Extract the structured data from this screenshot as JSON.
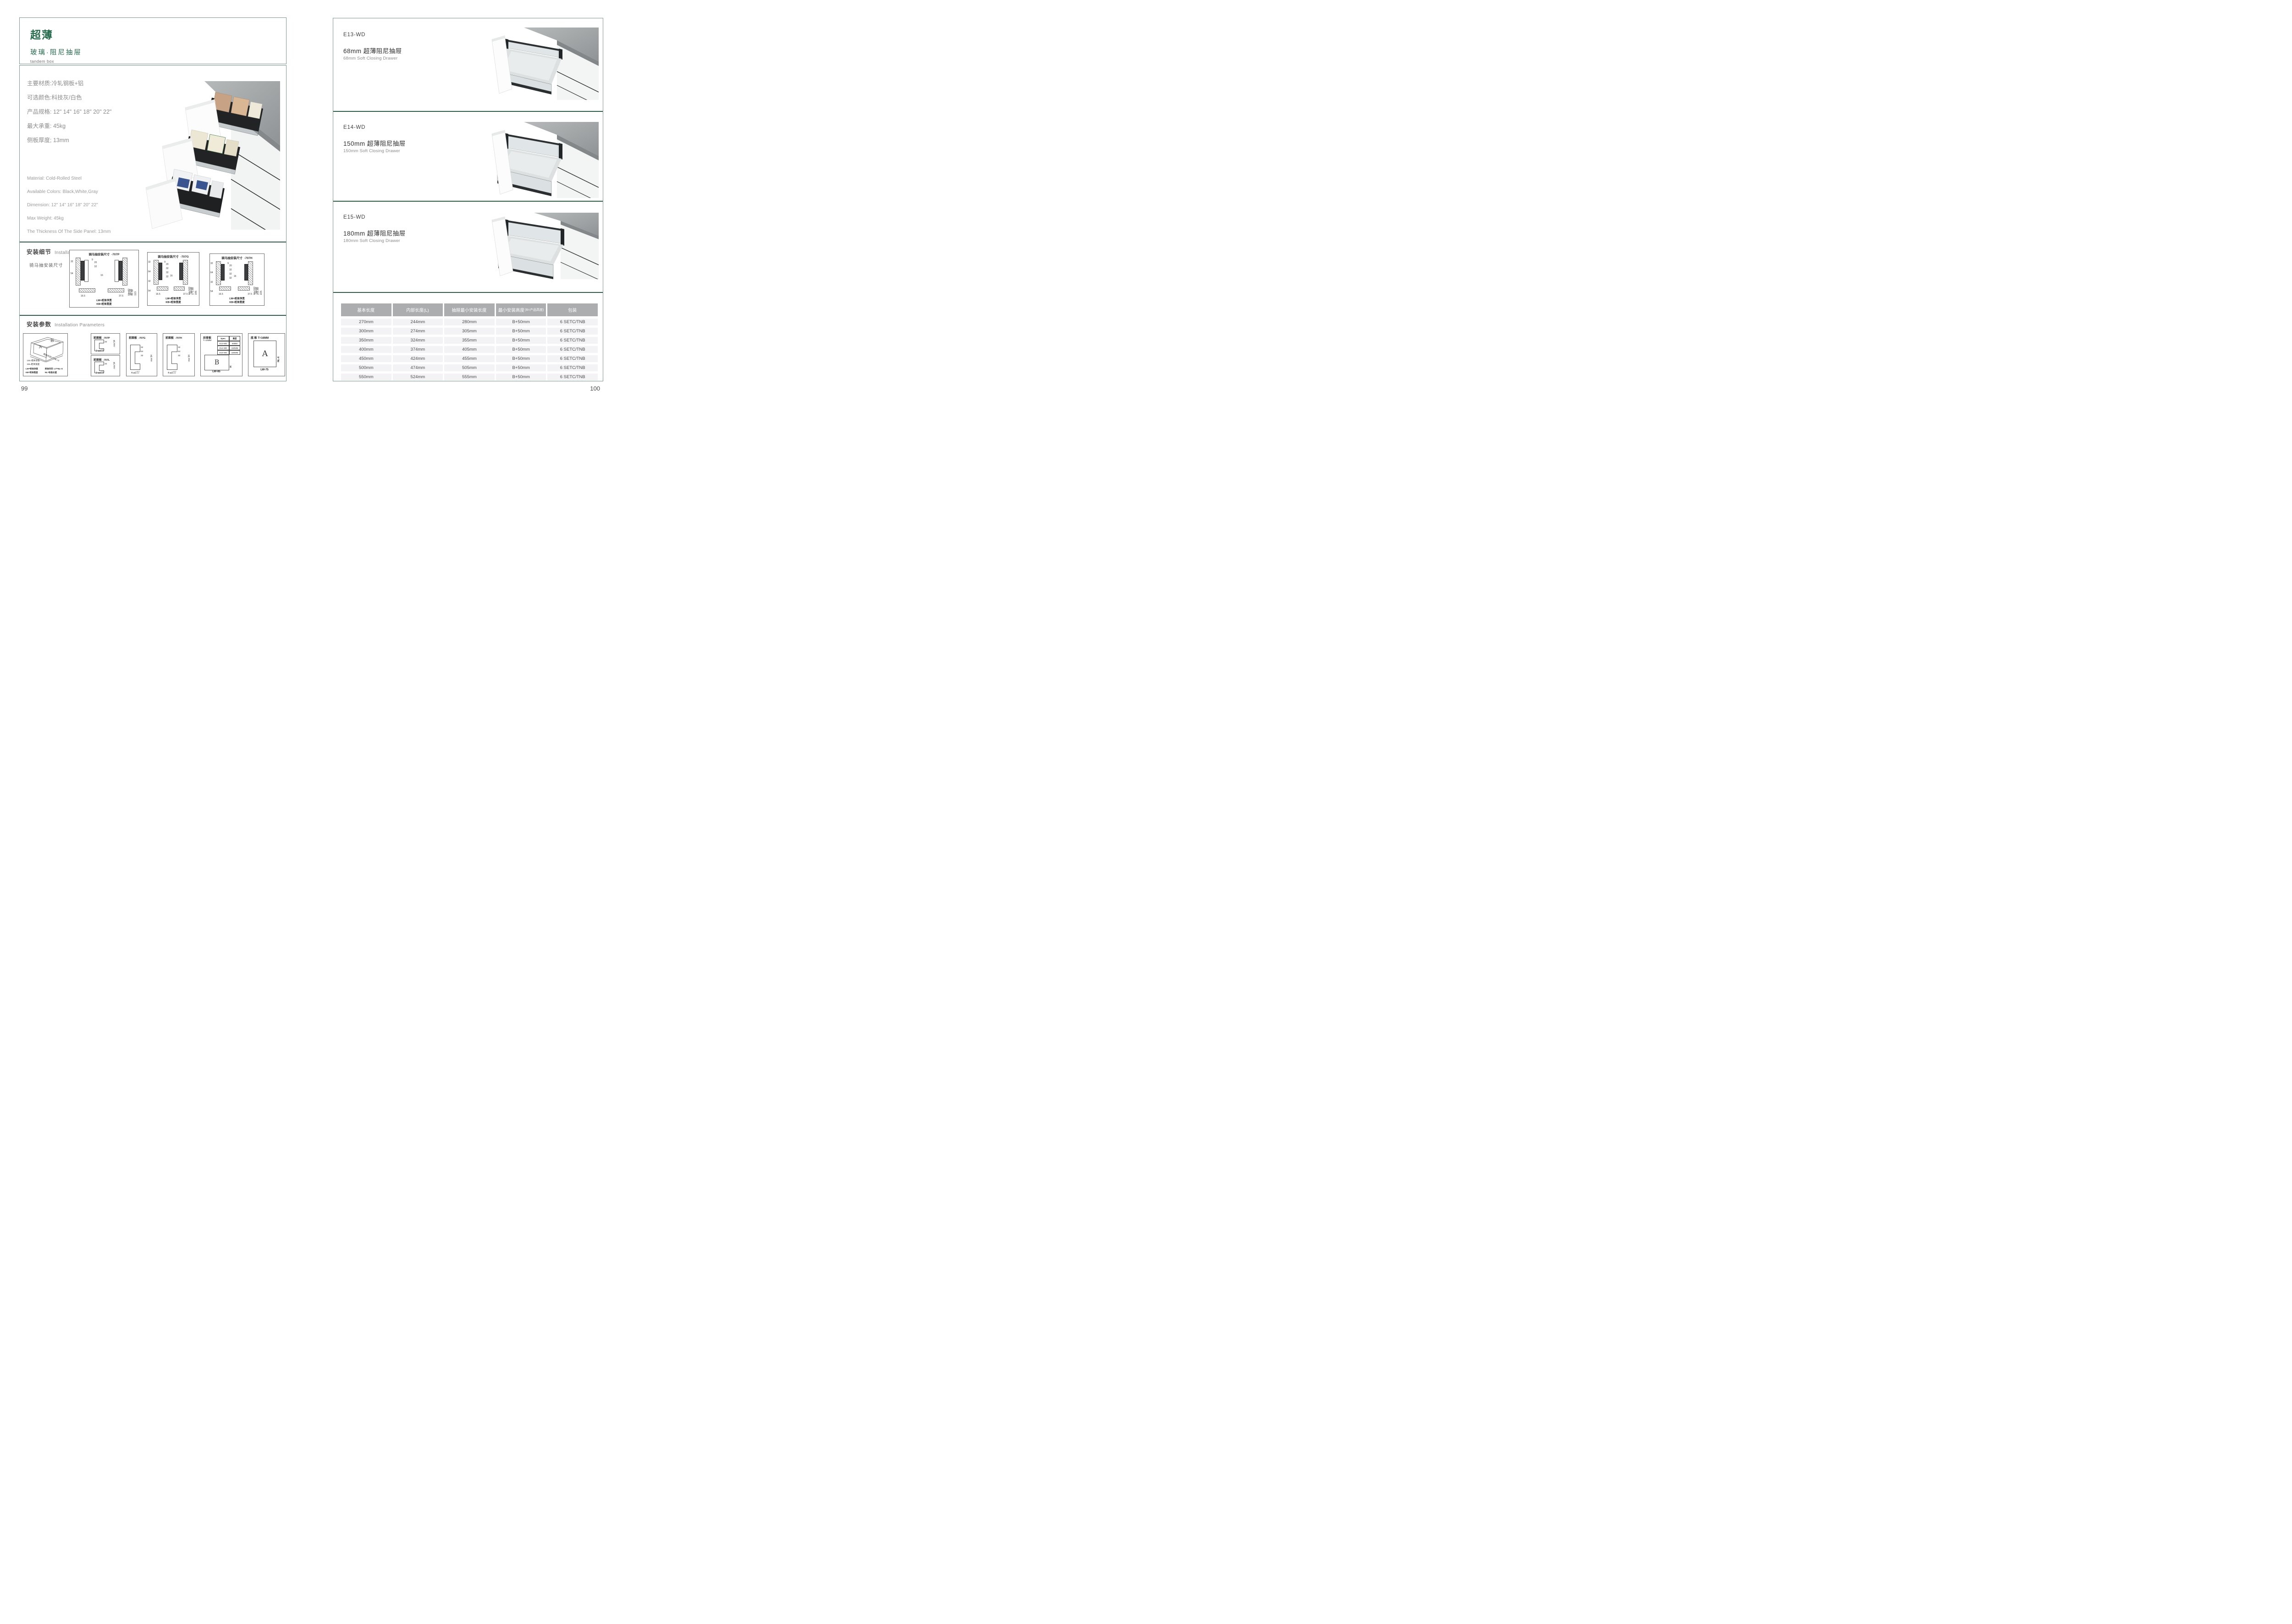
{
  "left_page": {
    "page_number": "99",
    "header": {
      "title_cn": "超薄",
      "subtitle_cn": "玻璃·阻尼抽屉",
      "subtitle_en": "tandem box"
    },
    "specs_cn": [
      "主要材质:冷轧钢板+铝",
      "可选颜色:科技灰/白色",
      "产品规格: 12\" 14\" 16\" 18\" 20\" 22\"",
      "最大承重: 45kg",
      "侧板厚度; 13mm"
    ],
    "specs_en": [
      "Material: Cold-Rolled Steel",
      "Available Colors: Black,White,Gray",
      "Dimension: 12\" 14\" 16\" 18\" 20\" 22\"",
      "Max Weight: 45kg",
      "The Thickness Of The Side Panel: 13mm"
    ],
    "installation_details": {
      "heading_cn": "安装细节",
      "heading_en": "Installation Details",
      "subheading_cn": "骑马抽安装尺寸",
      "diagrams": [
        {
          "title": "骑马抽安装尺寸",
          "code": "-707P",
          "top_dim": "9",
          "col_dims": [
            "20",
            "32"
          ],
          "center_dim": "16",
          "left_dims": [
            "32",
            "54"
          ],
          "right_dims": [
            "Min82",
            "91.50",
            "113"
          ],
          "bottom_dims": [
            "16.5",
            "37.5"
          ],
          "corner_dim": "Min36",
          "label_lw": "LW=柜体净宽",
          "label_kb": "KB=柜体宽度"
        },
        {
          "title": "骑马抽安装尺寸",
          "code": "-707G",
          "top_dim": "9",
          "col_dims": [
            "20",
            "32",
            "32",
            "32"
          ],
          "center_dim": "16",
          "left_dims": [
            "32",
            "64",
            "32",
            "54"
          ],
          "right_dims": [
            "Min162",
            "171.50",
            "195"
          ],
          "bottom_dims": [
            "16.5",
            "37.5"
          ],
          "corner_dim": "Min36",
          "label_lw": "LW=柜体净宽",
          "label_kb": "KB=柜体宽度"
        },
        {
          "title": "骑马抽安装尺寸",
          "code": "-707H",
          "top_dim": "9",
          "col_dims": [
            "20",
            "32",
            "32",
            "32"
          ],
          "center_dim": "16",
          "left_dims": [
            "32",
            "64",
            "32",
            "54"
          ],
          "right_dims": [
            "Min192",
            "201.50",
            "225"
          ],
          "bottom_dims": [
            "16.5",
            "37.5"
          ],
          "corner_dim": "Min36",
          "label_lw": "LW=柜体净宽",
          "label_kb": "KB=柜体宽度"
        }
      ]
    },
    "installation_parameters": {
      "heading_cn": "安装参数",
      "heading_en": "Installation Parameters",
      "iso_diagram": {
        "letter_a": "A",
        "letter_b": "B",
        "label_lw": "LW=柜体净宽",
        "label_kb": "KB=柜体宽度",
        "label_lt": "柜体内空LT=NL+3",
        "legend": [
          "LW=柜体净宽",
          "柜体内空: LT=NL+3",
          "KB=柜体宽度",
          "NL=标准长度"
        ]
      },
      "front_panels": [
        {
          "title": "前面板",
          "code": "-707P",
          "dims": [
            "32"
          ],
          "min_dim": "min 54",
          "note": "2-ø2",
          "tol_top": "+0.2",
          "tol_bottom": "-0.1"
        },
        {
          "title": "前面板",
          "code": "-707L",
          "dims": [
            "32"
          ],
          "min_dim": "min 54",
          "note": "2-ø2",
          "tol_top": "+0.2",
          "tol_bottom": "-0.1"
        },
        {
          "title": "前面板",
          "code": "-707G",
          "dims": [
            "32",
            "64",
            "32"
          ],
          "min_dim": "min 54",
          "note": "4-ø2",
          "tol_top": "+0.2",
          "tol_bottom": "-0.1"
        },
        {
          "title": "前面板",
          "code": "-707H",
          "dims": [
            "32",
            "64",
            "32"
          ],
          "min_dim": "min 54",
          "note": "4-ø2",
          "tol_top": "+0.2",
          "tol_bottom": "-0.1"
        }
      ],
      "back_panel": {
        "title": "后背板",
        "thickness": "T=16MM",
        "spec_table": {
          "headers": [
            "Spec.",
            "高度"
          ],
          "rows": [
            [
              "E13-WD",
              "68MM"
            ],
            [
              "E14-WD",
              "150MM"
            ],
            [
              "E15-WD",
              "180MM"
            ]
          ]
        },
        "letter": "B",
        "dim_h": "H",
        "dim_w": "LW-85"
      },
      "bottom_panel": {
        "title": "底 板 T=16MM",
        "letter": "A",
        "dim_v": "NL-6",
        "dim_w": "LW-75"
      }
    }
  },
  "right_page": {
    "page_number": "100",
    "products": [
      {
        "code": "E13-WD",
        "name_cn": "68mm 超薄阻尼抽屉",
        "name_en": "68mm Soft Closing Drawer"
      },
      {
        "code": "E14-WD",
        "name_cn": "150mm 超薄阻尼抽屉",
        "name_en": "150mm Soft Closing Drawer"
      },
      {
        "code": "E15-WD",
        "name_cn": "180mm 超薄阻尼抽屉",
        "name_en": "180mm Soft Closing Drawer"
      }
    ],
    "table": {
      "headers": [
        {
          "main": "基本长度",
          "sub": ""
        },
        {
          "main": "内部长度(L)",
          "sub": ""
        },
        {
          "main": "抽屉最小安装长度",
          "sub": ""
        },
        {
          "main": "最小安装高度",
          "sub": "(B=产品高度)"
        },
        {
          "main": "包装",
          "sub": ""
        }
      ],
      "rows": [
        [
          "270mm",
          "244mm",
          "280mm",
          "B+50mm",
          "6 SETC/TNB"
        ],
        [
          "300mm",
          "274mm",
          "305mm",
          "B+50mm",
          "6 SETC/TNB"
        ],
        [
          "350mm",
          "324mm",
          "355mm",
          "B+50mm",
          "6 SETC/TNB"
        ],
        [
          "400mm",
          "374mm",
          "405mm",
          "B+50mm",
          "6 SETC/TNB"
        ],
        [
          "450mm",
          "424mm",
          "455mm",
          "B+50mm",
          "6 SETC/TNB"
        ],
        [
          "500mm",
          "474mm",
          "505mm",
          "B+50mm",
          "6 SETC/TNB"
        ],
        [
          "550mm",
          "524mm",
          "555mm",
          "B+50mm",
          "6 SETC/TNB"
        ]
      ]
    }
  }
}
